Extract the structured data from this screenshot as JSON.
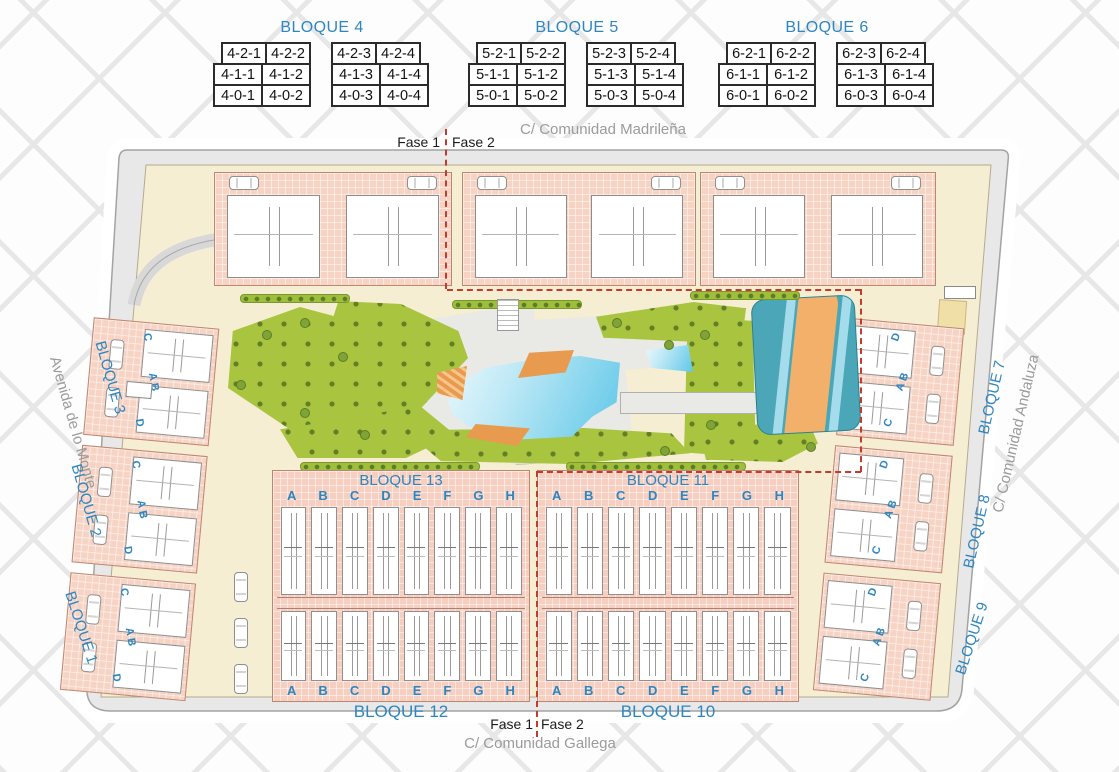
{
  "tables": [
    {
      "title": "BLOQUE 4",
      "rows": [
        [
          "4-2-1",
          "4-2-2",
          "4-2-3",
          "4-2-4"
        ],
        [
          "4-1-1",
          "4-1-2",
          "4-1-3",
          "4-1-4"
        ],
        [
          "4-0-1",
          "4-0-2",
          "4-0-3",
          "4-0-4"
        ]
      ]
    },
    {
      "title": "BLOQUE 5",
      "rows": [
        [
          "5-2-1",
          "5-2-2",
          "5-2-3",
          "5-2-4"
        ],
        [
          "5-1-1",
          "5-1-2",
          "5-1-3",
          "5-1-4"
        ],
        [
          "5-0-1",
          "5-0-2",
          "5-0-3",
          "5-0-4"
        ]
      ]
    },
    {
      "title": "BLOQUE 6",
      "rows": [
        [
          "6-2-1",
          "6-2-2",
          "6-2-3",
          "6-2-4"
        ],
        [
          "6-1-1",
          "6-1-2",
          "6-1-3",
          "6-1-4"
        ],
        [
          "6-0-1",
          "6-0-2",
          "6-0-3",
          "6-0-4"
        ]
      ]
    }
  ],
  "streets": {
    "top": "C/ Comunidad Madrileña",
    "bottom": "C/ Comunidad Gallega",
    "left": "Avenida de lo Monte",
    "right": "C/ Comunidad Andaluza"
  },
  "phases": {
    "fase1": "Fase 1",
    "fase2": "Fase 2"
  },
  "blocks": {
    "left": [
      "BLOQUE 3",
      "BLOQUE 2",
      "BLOQUE 1"
    ],
    "right": [
      "BLOQUE 7",
      "BLOQUE 8",
      "BLOQUE 9"
    ],
    "row_upper": [
      "BLOQUE 13",
      "BLOQUE 11"
    ],
    "row_lower": [
      "BLOQUE 12",
      "BLOQUE 10"
    ]
  },
  "letters": [
    "A",
    "B",
    "C",
    "D",
    "E",
    "F",
    "G",
    "H"
  ],
  "side_letters": {
    "left": [
      "C",
      "A B",
      "D"
    ],
    "right": [
      "D",
      "A B",
      "C"
    ]
  },
  "colors": {
    "blue": "#2e86c1",
    "red": "#c43b2c",
    "streetgray": "#9b9b9b",
    "green": "#a9c43e",
    "teal": "#4ba7b7",
    "river": "#f2b06b",
    "orange": "#e89a4e",
    "pink": "#f7d3c4",
    "cream": "#f6eed3",
    "road": "#e8e8e8"
  }
}
